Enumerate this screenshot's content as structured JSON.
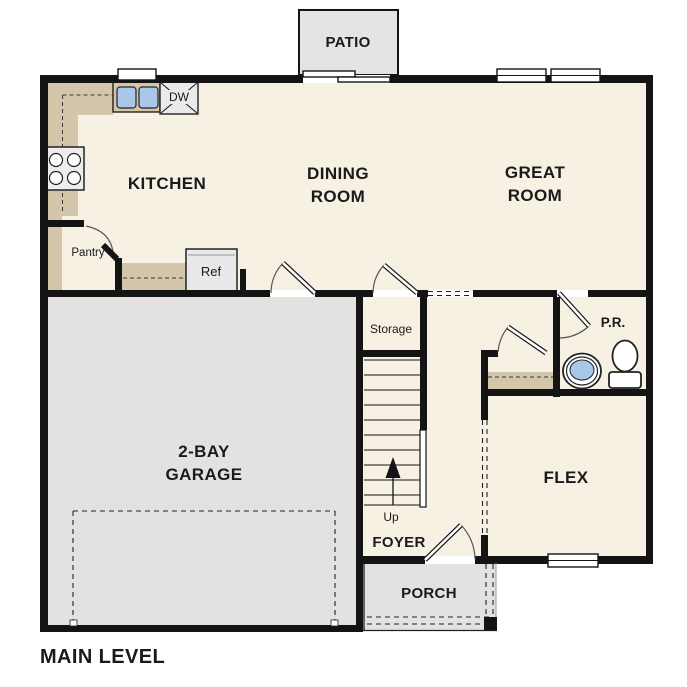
{
  "title": "MAIN LEVEL",
  "labels": {
    "patio": "PATIO",
    "kitchen": "KITCHEN",
    "dining_line1": "DINING",
    "dining_line2": "ROOM",
    "great_line1": "GREAT",
    "great_line2": "ROOM",
    "garage_line1": "2-BAY",
    "garage_line2": "GARAGE",
    "flex": "FLEX",
    "foyer": "FOYER",
    "porch": "PORCH",
    "storage": "Storage",
    "pantry": "Pantry",
    "powder_room": "P.R.",
    "dishwasher": "DW",
    "refrigerator": "Ref",
    "stairs_up": "Up"
  },
  "colors": {
    "floor": "#f7f1e4",
    "garage": "#e4e2e1",
    "patio": "#e6e4e3",
    "porch": "#e4e2e1",
    "counter": "#d4c6ab",
    "closet": "#d4c6ab",
    "wall": "#141414",
    "sink": "#a9c7e9",
    "appliance": "#eaeaea",
    "text": "#1a1a1a"
  }
}
